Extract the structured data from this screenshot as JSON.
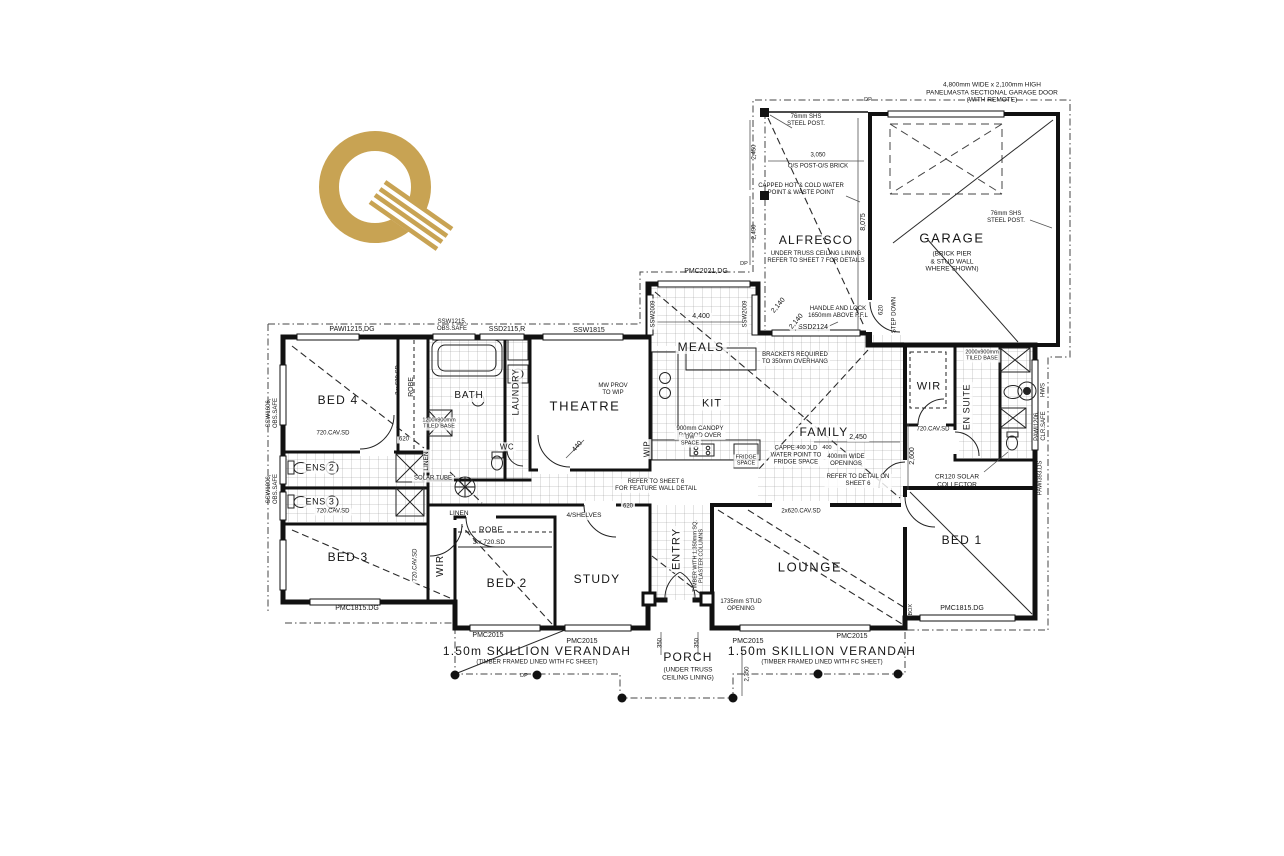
{
  "branding": {
    "logo_letter": "Q",
    "logo_color": "#C8A353"
  },
  "rooms": {
    "garage": "GARAGE",
    "garage_note": "(BRICK PIER\n& STUD WALL\nWHERE SHOWN)",
    "alfresco": "ALFRESCO",
    "alfresco_note": "UNDER TRUSS CEILING LINING\nREFER TO SHEET 7 FOR DETAILS",
    "meals": "MEALS",
    "kitchen": "KIT",
    "family": "FAMILY",
    "theatre": "THEATRE",
    "lounge": "LOUNGE",
    "entry": "ENTRY",
    "study": "STUDY",
    "porch": "PORCH",
    "porch_note": "(UNDER TRUSS\nCEILING LINING)",
    "bed1": "BED 1",
    "bed2": "BED 2",
    "bed3": "BED 3",
    "bed4": "BED 4",
    "bath": "BATH",
    "laundry": "LAUNDRY",
    "wc": "WC",
    "ens2": "ENS 2",
    "ens3": "ENS 3",
    "ensuite": "EN SUITE",
    "wir": "WIR",
    "wip": "WIP",
    "linen": "LINEN",
    "robe": "ROBE",
    "shelves": "4/SHELVES",
    "verandah": "1.50m SKILLION VERANDAH",
    "verandah_note": "(TIMBER FRAMED LINED WITH FC SHEET)"
  },
  "notes": {
    "garage_door": "4,800mm WIDE x 2,100mm HIGH\nPANELMASTA SECTIONAL GARAGE DOOR\n(WITH REMOTE)",
    "steel_post": "76mm SHS\nSTEEL POST.",
    "os_post": "O/S POST-O/S BRICK",
    "capped_hot": "CAPPED HOT & COLD WATER\nPOINT & WASTE POINT",
    "handle": "HANDLE AND LOCK\n1650mm ABOVE F.F.L",
    "step_down": "STEP DOWN",
    "brackets": "BRACKETS REQUIRED\nTO 350mm OVERHANG",
    "canopy": "900mm CANOPY\nR/HOOD OVER",
    "capped_cold": "CAPPED COLD\nWATER POINT TO\nFRIDGE SPACE",
    "fridge": "FRIDGE\nSPACE",
    "dw": "DW\nSPACE",
    "openings": "400mm WIDE\nOPENINGS",
    "refer6": "REFER TO DETAIL ON\nSHEET 6",
    "feature": "REFER TO SHEET 6\nFOR FEATURE WALL DETAIL",
    "mw": "MW PROV\nTO WIP",
    "solar_tube": "SOLAR TUBE",
    "collector": "CR120 SOLAR\nCOLLECTOR",
    "tiled_ens": "2000x900mm\nTILED BASE",
    "tiled_bath": "1200x900mm\nTILED BASE",
    "stud": "1735mm STUD\nOPENING",
    "columns": "TIMBER WITH 1,350mm SQ.\nPLASTER COLUMNS",
    "hws": "HWS",
    "mbox": "MBOX",
    "dp": "DP"
  },
  "codes": {
    "pmc2021": "PMC2021,DG",
    "ssw2009": "SSW2009",
    "ssd2124": "SSD2124",
    "ssw1815": "SSW1815",
    "ssd2115": "SSD2115,R",
    "pawi1215": "PAWI1215,DG",
    "obs_bath": "SSW1215,\nOBS.SAFE",
    "ssw1606": "SSW1606,\nOBS.SAFE",
    "ssw1006": "SSW1006,\nOBS.SAFE",
    "pawi1206": "PAWI1206,\nCLR.SAFE",
    "pawi393": "PAWI393.DS",
    "pmc1815": "PMC1815.DG",
    "pmc2015": "PMC2015",
    "cav720": "720.CAV.SD",
    "cav620x2": "2x620.CAV.SD",
    "sd620x3": "3 x 620.SD",
    "sd720x3": "3 x 720.SD"
  },
  "dims": {
    "d4400": "4,400",
    "d2140": "2,140",
    "d3050": "3,050",
    "d8075": "8,075",
    "d2450": "2,450",
    "d2490": "2,490",
    "d2600": "2,600",
    "d2450b": "2,450",
    "d400": "400",
    "d440": "440",
    "d620": "620",
    "d350": "350",
    "d2350": "2,350"
  }
}
